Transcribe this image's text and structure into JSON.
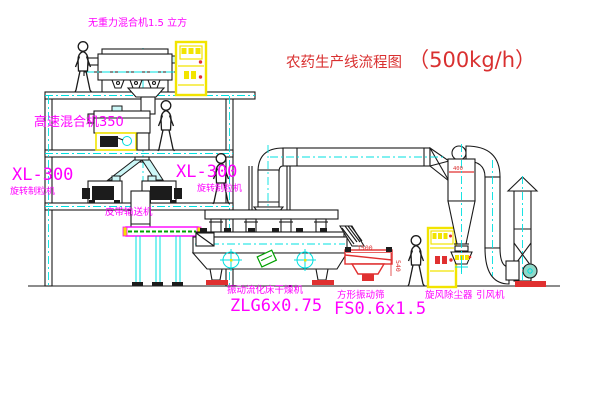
{
  "title": {
    "prefix": "农药生产线流程图",
    "capacity": "（500kg/h）"
  },
  "labels": {
    "top_mixer": "无重力混合机1.5 立方",
    "high_speed_mixer": "高速混合机350",
    "granulator_left_model": "XL-300",
    "granulator_left_name": "旋转制粒机",
    "granulator_mid_model": "XL-300",
    "granulator_mid_name": "旋转制粒机",
    "belt_conveyor": "皮带输送机",
    "fluid_bed_name": "振动流化床干燥机",
    "fluid_bed_model": "ZLG6x0.75",
    "screen_name": "方形振动筛",
    "screen_model": "FS0.6x1.5",
    "cyclone": "旋风除尘器",
    "fan": "引风机"
  },
  "dimensions": {
    "screen_length": "1500",
    "screen_height": "540",
    "cyclone_note": "400"
  },
  "colors": {
    "label_magenta": "#FF00FF",
    "title_red": "#D93030",
    "cabinet_yellow": "#F2E400",
    "centerline_cyan": "#00E0E0",
    "conveyor_green": "#00A000",
    "line_black": "#1A1A1A"
  }
}
